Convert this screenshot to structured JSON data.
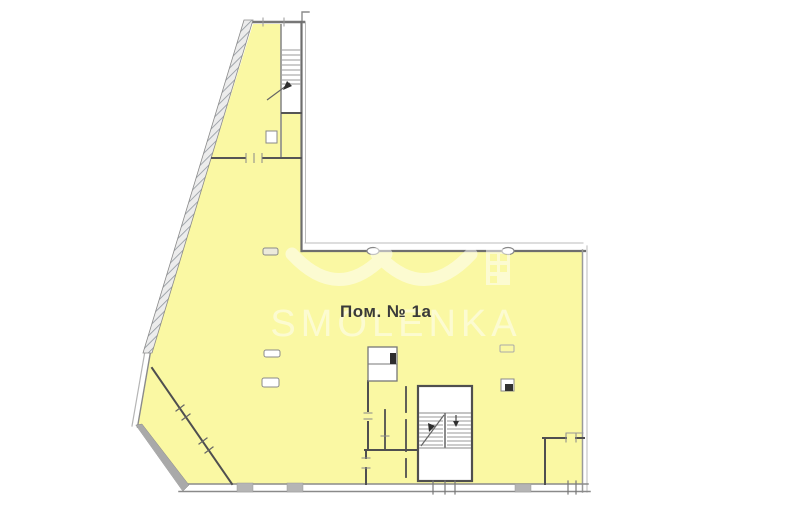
{
  "plan": {
    "room_label": "Пом. № 1а",
    "type_note": "floor-plan"
  },
  "watermark": {
    "text": "SMOLENKA"
  },
  "icons": {
    "logo_arcs": "smolenka-logo-arcs",
    "building": "smolenka-building-icon",
    "stair_arrows": "stair-direction-arrow"
  },
  "colors": {
    "background": "#FFFFFF",
    "floor_fill": "#FAF8A3",
    "wall_dark": "#4F4F4F",
    "wall_mid": "#8A8A8A",
    "wall_light": "#B5B5B5",
    "pier_gray": "#B5B5B5",
    "watermark_white": "rgba(255,255,255,0.5)",
    "label_text": "#3A3A3A"
  }
}
